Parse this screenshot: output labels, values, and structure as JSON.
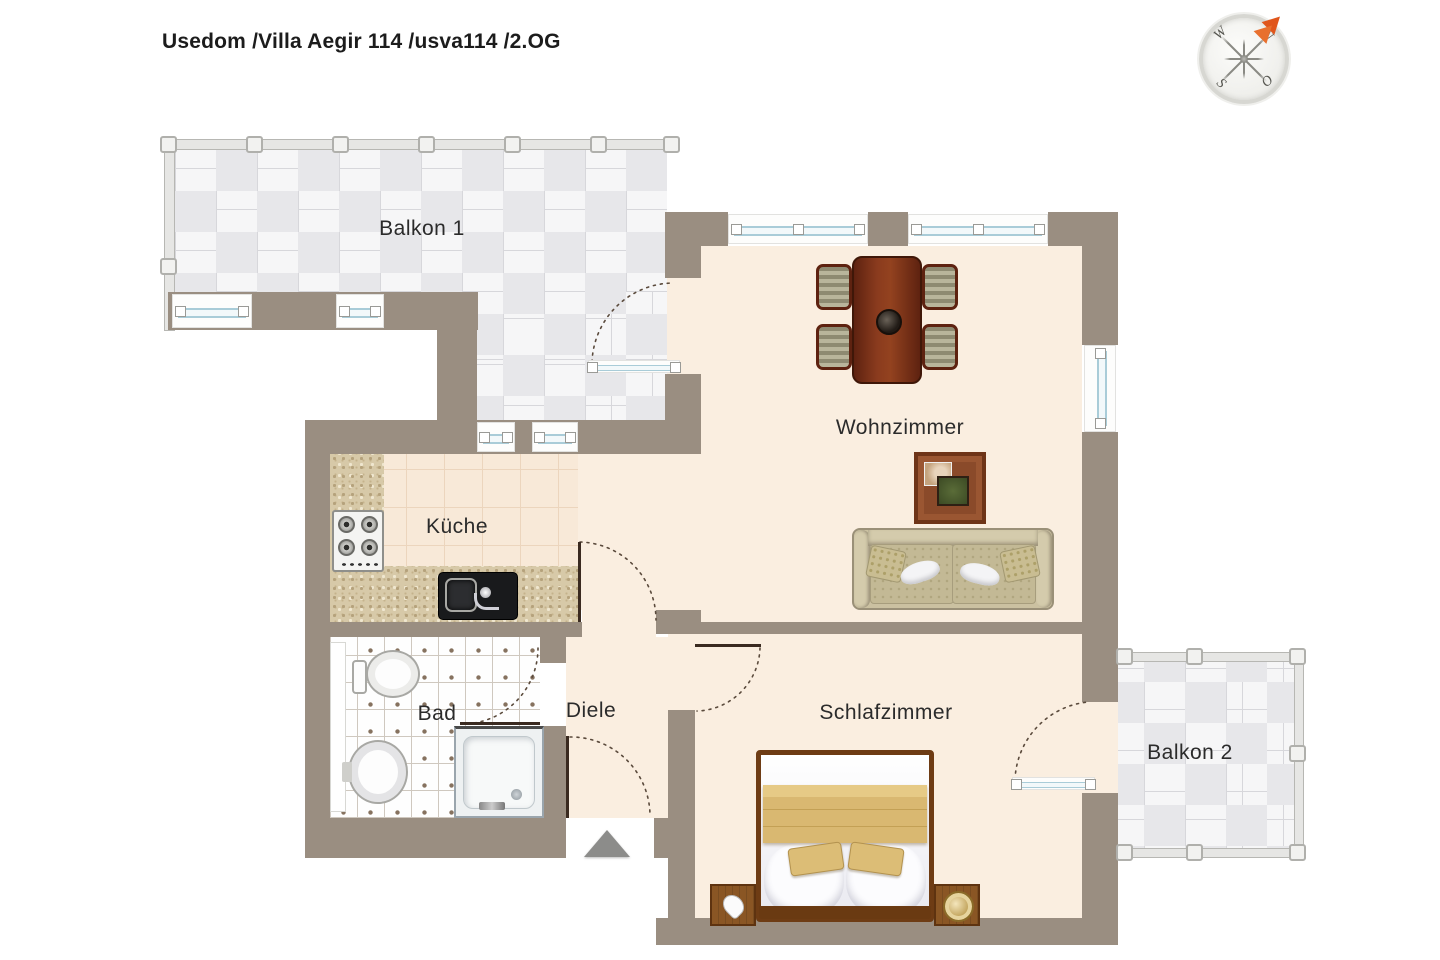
{
  "page": {
    "title": "Usedom /Villa Aegir 114 /usva114 /2.OG"
  },
  "compass": {
    "north": "N",
    "east": "O",
    "south": "S",
    "west": "W"
  },
  "rooms": {
    "balkon1": {
      "label": "Balkon 1"
    },
    "wohnzimmer": {
      "label": "Wohnzimmer"
    },
    "kueche": {
      "label": "Küche"
    },
    "bad": {
      "label": "Bad"
    },
    "diele": {
      "label": "Diele"
    },
    "schlafzimmer": {
      "label": "Schlafzimmer"
    },
    "balkon2": {
      "label": "Balkon 2"
    }
  },
  "colors": {
    "wall": "#9a8e81",
    "interior_floor": "#faeee0",
    "balcony_tile_dark": "#e7e7ea",
    "balcony_tile_light": "#f6f6f7",
    "kitchen_tile": "#f8e9d8",
    "counter_granite": "#d7c9a8",
    "window_glazing": "#a9ccd8",
    "door_swing": "#5a4a3c",
    "dining_wood": "#8a3b1e",
    "bed_wood": "#6e3c14",
    "textile_tan": "#d9b871",
    "sofa_beige": "#cbc1a1",
    "entrance_arrow": "#8c8c8a",
    "compass_arrow": "#e0561c"
  }
}
